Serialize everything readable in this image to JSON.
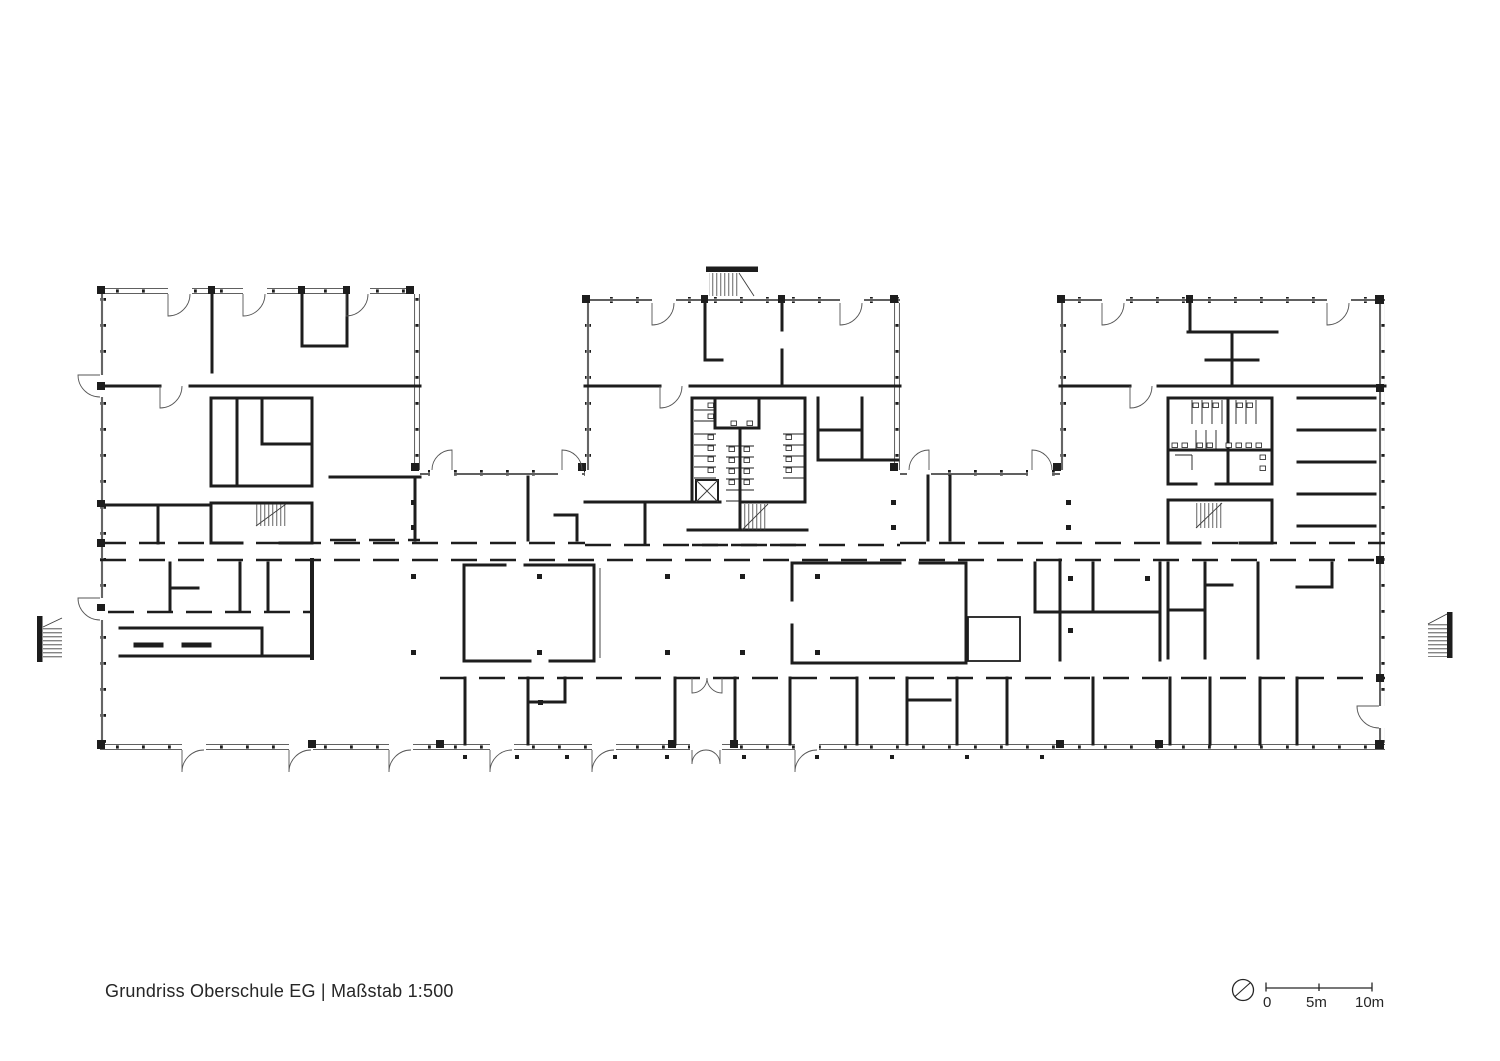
{
  "page": {
    "background_color": "#ffffff",
    "ink_color": "#1d1d1d",
    "thin_line_color": "#4a4a4a"
  },
  "drawing": {
    "type": "architectural-floor-plan",
    "building": "Oberschule",
    "level": "EG",
    "caption": "Grundriss Oberschule EG | Maßstab 1:500",
    "caption_title": "Grundriss Oberschule EG",
    "caption_divider": "|",
    "caption_scale": "Maßstab 1:500",
    "scale_ratio": "1:500"
  },
  "scale_bar": {
    "label_zero": "0",
    "label_mid": "5m",
    "label_end": "10m",
    "tick_labels": [
      "0",
      "5m",
      "10m"
    ],
    "total_length_m": 10
  },
  "symbols": {
    "north_icon": "north-arrow-icon",
    "stair_icon": "stair-hatch",
    "elevator_icon": "elevator-x-box",
    "column_icon": "structural-column-square"
  }
}
